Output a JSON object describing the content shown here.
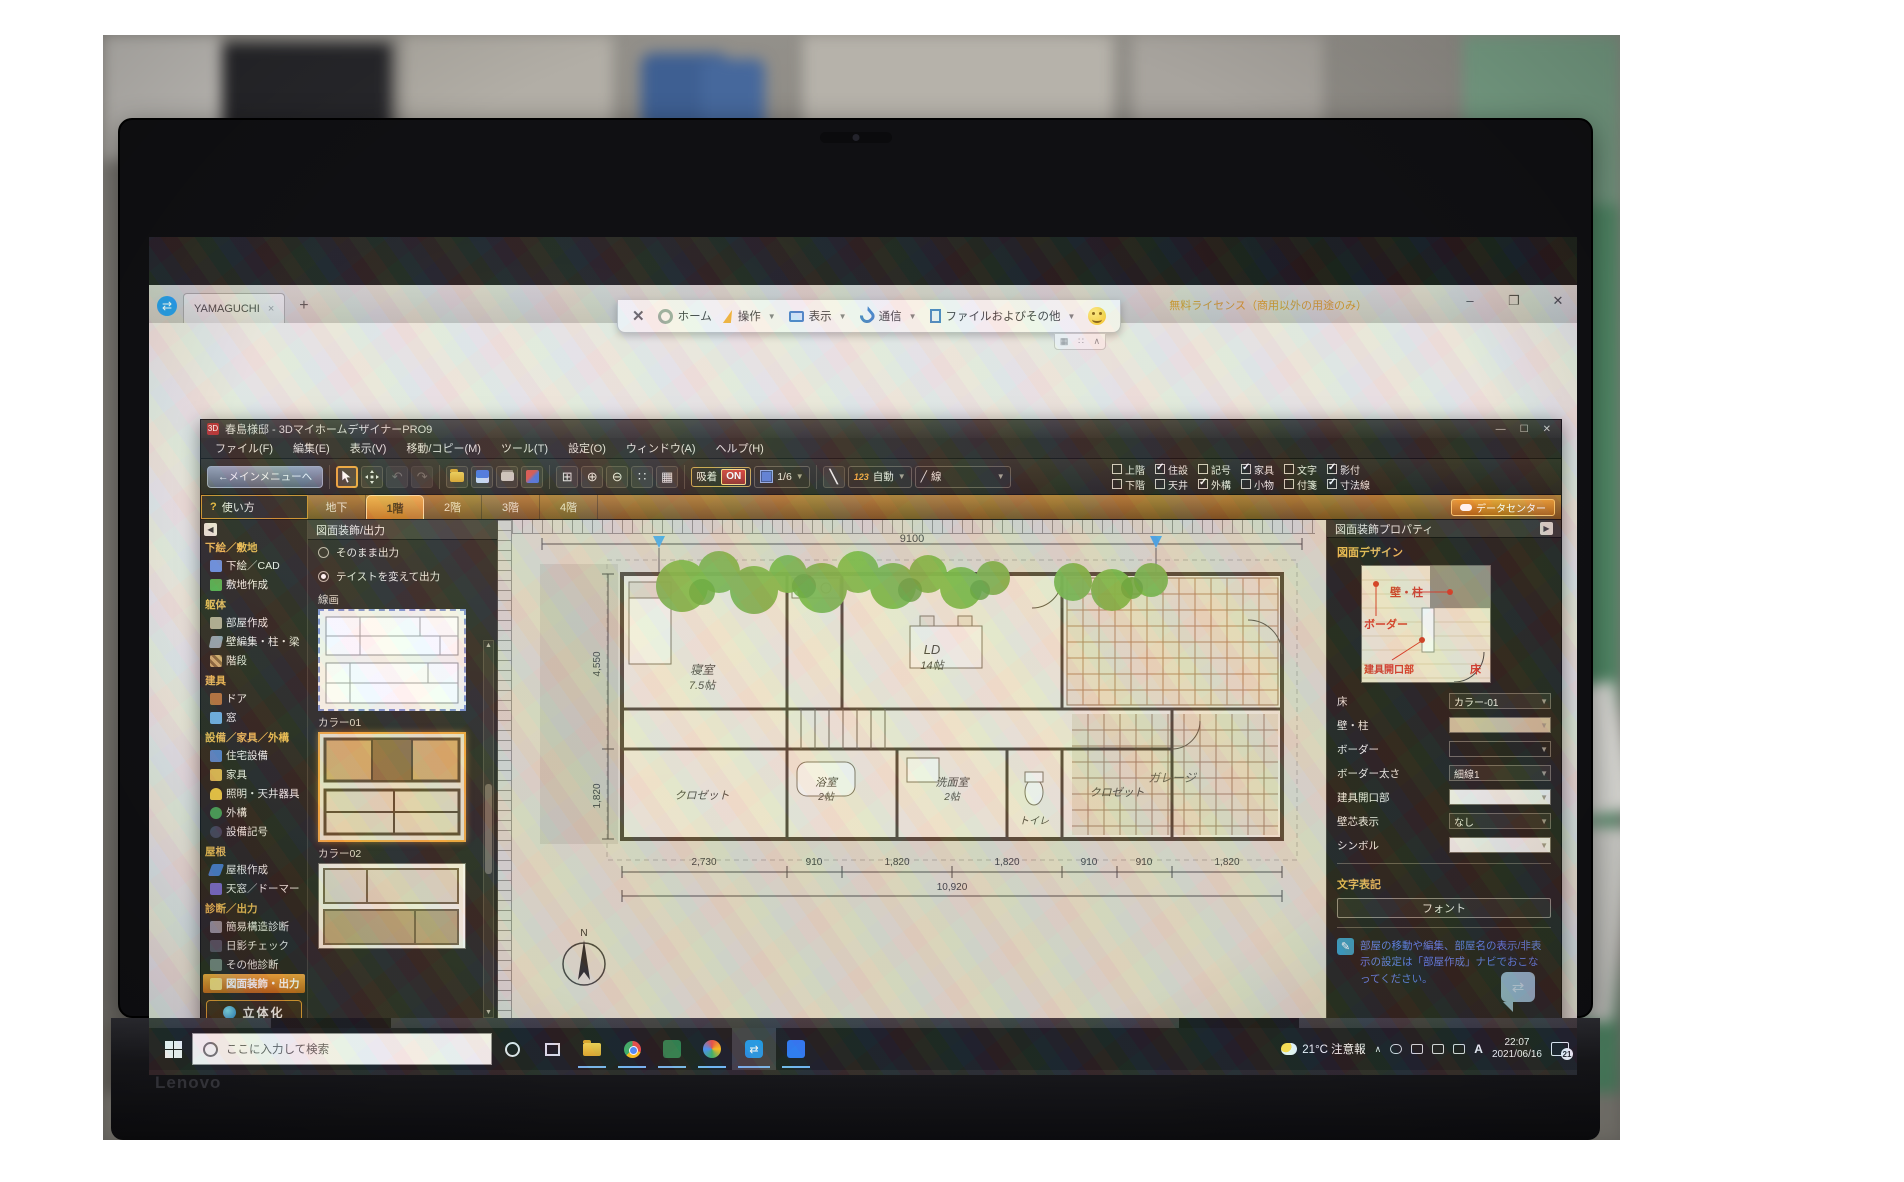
{
  "laptop": {
    "brand": "Lenovo",
    "model": "X1 Carbon"
  },
  "teamviewer": {
    "tab_title": "YAMAGUCHI",
    "tab_close": "×",
    "new_tab": "+",
    "license": "無料ライセンス（商用以外の用途のみ）",
    "window_controls": {
      "min": "–",
      "max": "❐",
      "close": "✕"
    },
    "toolbar": {
      "close": "✕",
      "items": [
        "ホーム",
        "操作",
        "表示",
        "通信",
        "ファイルおよびその他"
      ]
    }
  },
  "app": {
    "title": "春島様邸 - 3DマイホームデザイナーPRO9",
    "window_controls": {
      "min": "—",
      "max": "☐",
      "close": "✕"
    },
    "menus": [
      "ファイル(F)",
      "編集(E)",
      "表示(V)",
      "移動/コピー(M)",
      "ツール(T)",
      "設定(O)",
      "ウィンドウ(A)",
      "ヘルプ(H)"
    ],
    "toolbar": {
      "main_menu": "←メインメニューへ",
      "snap_label": "吸着",
      "snap_state": "ON",
      "grid_scale": "1/6",
      "num_badge": "123",
      "auto_label": "自動",
      "line_glyph": "╱",
      "line_label": "線"
    },
    "layers": [
      {
        "t": "上階",
        "tc": false,
        "b": "下階",
        "bc": false
      },
      {
        "t": "住設",
        "tc": true,
        "b": "天井",
        "bc": false
      },
      {
        "t": "記号",
        "tc": false,
        "b": "外構",
        "bc": true
      },
      {
        "t": "家具",
        "tc": true,
        "b": "小物",
        "bc": false
      },
      {
        "t": "文字",
        "tc": false,
        "b": "付箋",
        "bc": false
      },
      {
        "t": "影付",
        "tc": true,
        "b": "寸法線",
        "bc": true
      }
    ],
    "help_button": "使い方",
    "help_q": "?",
    "tabs": [
      {
        "label": "地下",
        "active": false
      },
      {
        "label": "1階",
        "active": true
      },
      {
        "label": "2階",
        "active": false
      },
      {
        "label": "3階",
        "active": false
      },
      {
        "label": "4階",
        "active": false
      }
    ],
    "datacenter": "データセンター"
  },
  "sidebar": {
    "sections": [
      {
        "header": "下絵／敷地",
        "items": [
          {
            "label": "下絵／CAD"
          },
          {
            "label": "敷地作成"
          }
        ]
      },
      {
        "header": "躯体",
        "items": [
          {
            "label": "部屋作成"
          },
          {
            "label": "壁編集・柱・梁"
          },
          {
            "label": "階段"
          }
        ]
      },
      {
        "header": "建具",
        "items": [
          {
            "label": "ドア"
          },
          {
            "label": "窓"
          }
        ]
      },
      {
        "header": "設備／家具／外構",
        "items": [
          {
            "label": "住宅設備"
          },
          {
            "label": "家具"
          },
          {
            "label": "照明・天井器具"
          },
          {
            "label": "外構"
          },
          {
            "label": "設備記号"
          }
        ]
      },
      {
        "header": "屋根",
        "items": [
          {
            "label": "屋根作成"
          },
          {
            "label": "天窓／ドーマー"
          }
        ]
      },
      {
        "header": "診断／出力",
        "items": [
          {
            "label": "簡易構造診断"
          },
          {
            "label": "日影チェック"
          },
          {
            "label": "その他診断"
          },
          {
            "label": "図面装飾・出力",
            "active": true
          }
        ]
      }
    ],
    "solid_button": "立体化"
  },
  "decor": {
    "title": "図面装飾/出力",
    "radios": [
      {
        "label": "そのまま出力",
        "selected": false
      },
      {
        "label": "テイストを変えて出力",
        "selected": true
      }
    ],
    "groups": [
      "線画",
      "カラー01",
      "カラー02"
    ],
    "export_button": "画像出力",
    "print_button": "印刷"
  },
  "plan": {
    "dim_top": "9100",
    "dim_left_upper": "4,550",
    "dim_left_lower": "1,820",
    "dims_bottom": [
      "2,730",
      "910",
      "1,820",
      "1,820",
      "910",
      "910",
      "1,820"
    ],
    "dim_total": "10,920",
    "rooms": {
      "bedroom": "寝室",
      "bedroom_size": "7.5帖",
      "ld": "LD",
      "ld_size": "14帖",
      "garage": "ガレージ",
      "closet1": "クロゼット",
      "bath": "浴室",
      "bath_size": "2帖",
      "washroom": "洗面室",
      "washroom_size": "2帖",
      "toilet": "トイレ",
      "closet2": "クロゼット"
    },
    "compass": "N"
  },
  "props": {
    "title": "図面装飾プロパティ",
    "design_header": "図面デザイン",
    "preview": {
      "wall": "壁・柱",
      "border": "ボーダー",
      "opening": "建具開口部",
      "floor": "床"
    },
    "fields": [
      {
        "label": "床",
        "value": "カラー-01"
      },
      {
        "label": "壁・柱",
        "value": ""
      },
      {
        "label": "ボーダー",
        "value": ""
      },
      {
        "label": "ボーダー太さ",
        "value": "細線1"
      },
      {
        "label": "建具開口部",
        "value": ""
      },
      {
        "label": "壁芯表示",
        "value": "なし"
      },
      {
        "label": "シンボル",
        "value": ""
      }
    ],
    "text_header": "文字表記",
    "font_button": "フォント",
    "note": "部屋の移動や編集、部屋名の表示/非表示の設定は「部屋作成」ナビでおこなってください。"
  },
  "status": {
    "left": "左:図形選択 SPACE:次選択 Drag:移動(+Ctrlでコピー)",
    "snap": "吸着: On",
    "grid": "グリッド: Off"
  },
  "remote_taskbar": {
    "search_placeholder": "ここに入力して検索",
    "weather": "21°C",
    "ime": "A",
    "time": "22:07",
    "date": "2021/06/16",
    "badge": "3"
  },
  "local_taskbar": {
    "search_placeholder": "ここに入力して検索",
    "weather": "21°C 注意報",
    "ime": "A",
    "time": "22:07",
    "date": "2021/06/16",
    "badge": "21"
  }
}
